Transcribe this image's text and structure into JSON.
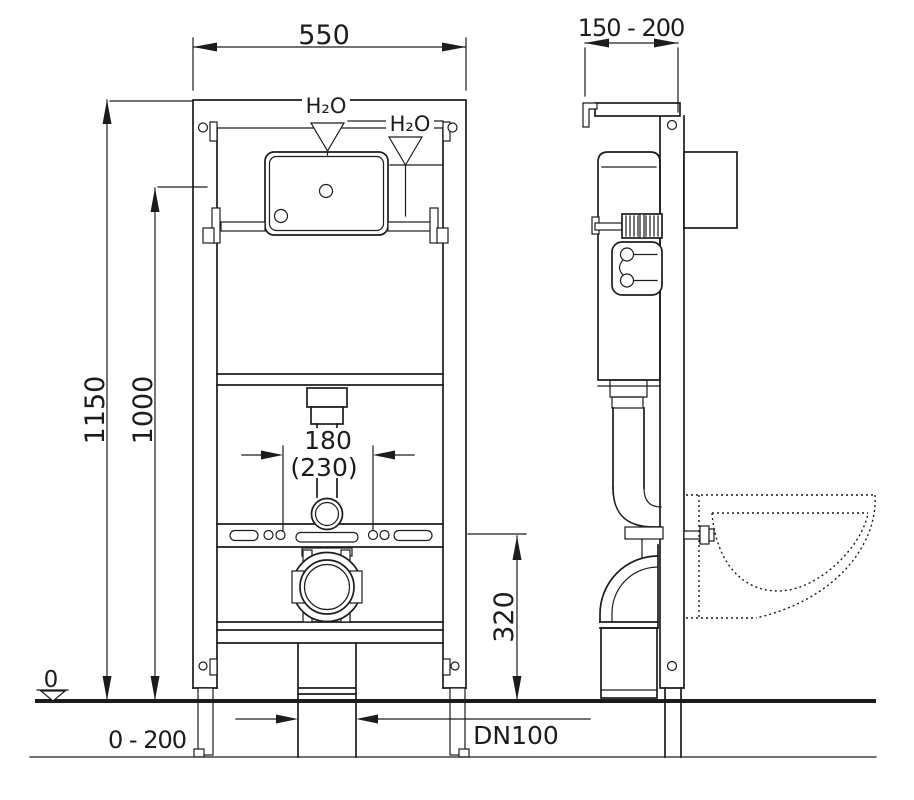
{
  "dimensions": {
    "frame_width": "550",
    "frame_depth_range": "150 - 200",
    "overall_height": "1150",
    "inner_height": "1000",
    "flush_offset": "180",
    "flush_offset_alt": "(230)",
    "outlet_height": "320",
    "floor_datum": "0",
    "foot_adjustment_range": "0 - 200",
    "drain_size": "DN100"
  },
  "labels": {
    "water_supply_top": "H₂O",
    "water_supply_side": "H₂O"
  },
  "colors": {
    "line": "#1c1c1c",
    "background": "#ffffff"
  }
}
